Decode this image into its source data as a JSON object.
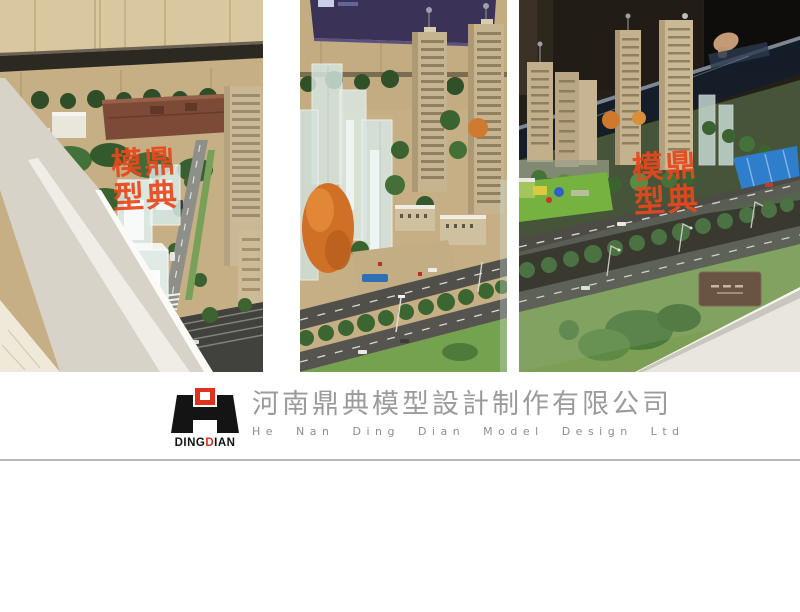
{
  "stamps": [
    {
      "tl": "模",
      "tr": "鼎",
      "bl": "型",
      "br": "典"
    },
    {
      "tl": "模",
      "tr": "鼎",
      "bl": "型",
      "br": "典"
    }
  ],
  "footer": {
    "logo_word_seg1": "DING",
    "logo_word_seg2": "D",
    "logo_word_seg3": "IAN",
    "company_cn": "河南鼎典模型設計制作有限公司",
    "company_en": "He Nan Ding Dian Model Design Ltd"
  },
  "colors": {
    "accent_red": "#e0301e",
    "stamp_red": "#e8481c",
    "text_gray": "#9b9b9b"
  }
}
